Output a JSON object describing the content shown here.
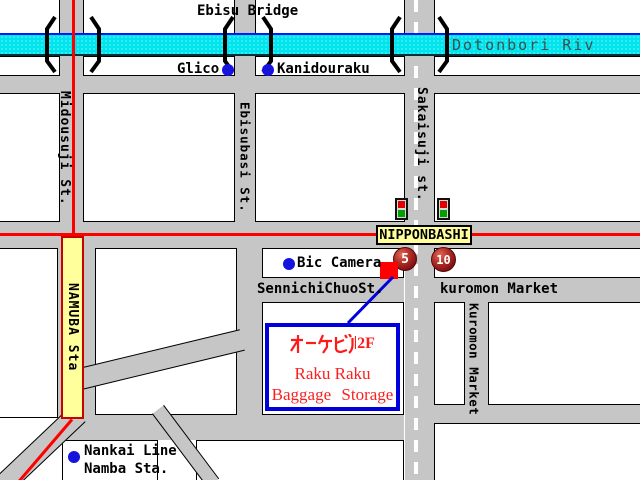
{
  "map": {
    "bridge_label": "Ebisu Bridge",
    "river_label": "Dotonbori Riv",
    "landmarks": {
      "glico": "Glico",
      "kanidouraku": "Kanidouraku",
      "bic_camera": "Bic Camera",
      "nankai_line": "Nankai Line",
      "nankai_station": "Namba Sta."
    },
    "streets": {
      "midousuji": "Midousuji St.",
      "ebisubashi": "Ebisubasi St.",
      "sakaisuji": "Sakaisuji st.",
      "sennichi_chuo": "SennichiChuoSt.",
      "kuromon_market_h": "kuromon Market",
      "kuromon_market_v": "Kuromon Market"
    },
    "stations": {
      "namba": "NAMUBA Sta",
      "nipponbashi": "NIPPONBASHI"
    },
    "exits": {
      "exit5": "5",
      "exit10": "10"
    },
    "destination": {
      "building": "オーケビル2F",
      "floor": "2F",
      "name_line1": "Raku Raku",
      "name_line2": "Baggage Storage"
    },
    "colors": {
      "road_gray": "#C6C6C6",
      "river_cyan": "#00E4EE",
      "route_red": "#FF0000",
      "station_yellow": "#FFFF9C",
      "marker_blue": "#1414DD",
      "dest_border_blue": "#0000DD",
      "exit_maroon": "#7D0F12"
    }
  }
}
